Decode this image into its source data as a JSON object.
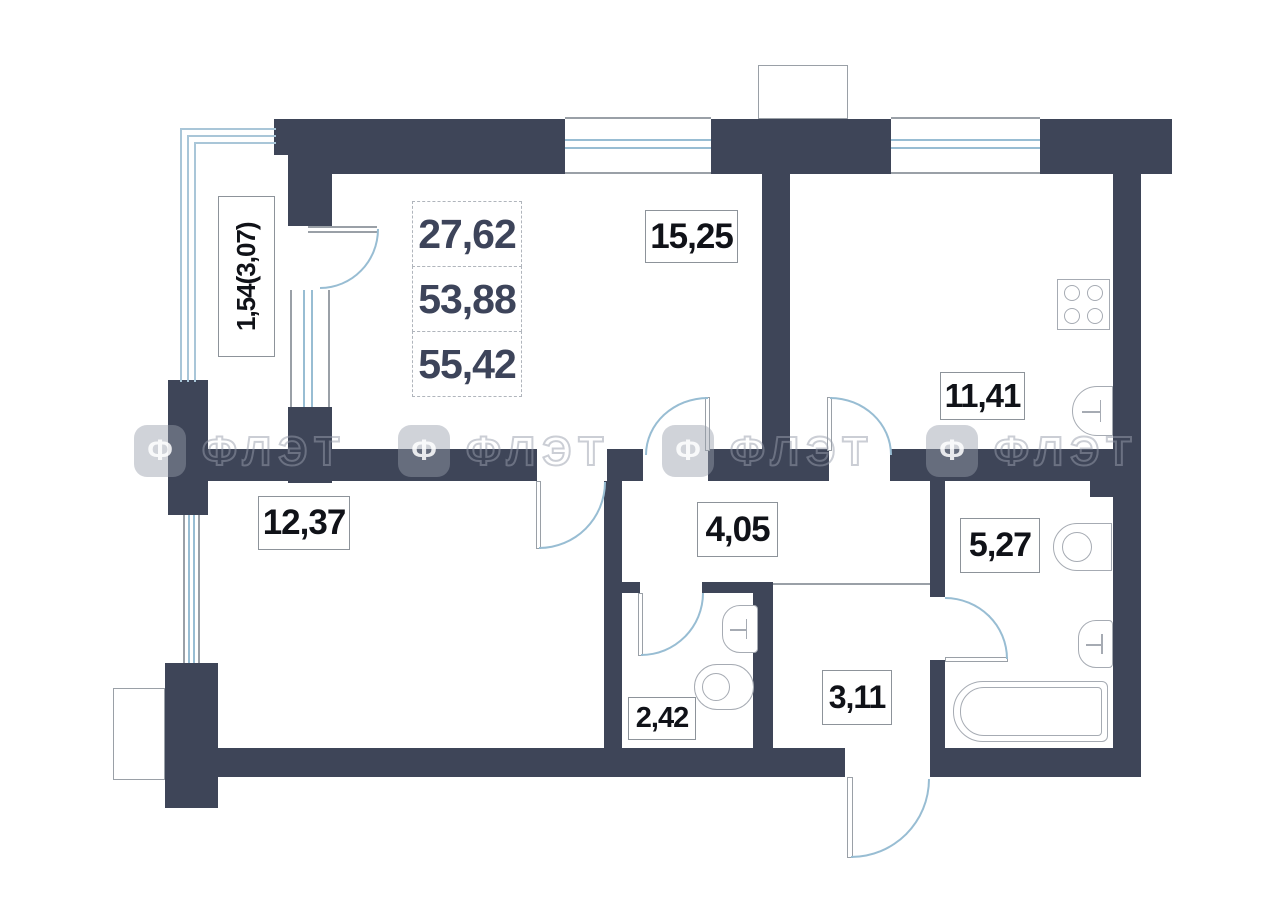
{
  "plan": {
    "title": "apartment-floor-plan",
    "area_summary": {
      "values": [
        "27,62",
        "53,88",
        "55,42"
      ]
    },
    "rooms": [
      {
        "id": "living",
        "label": "15,25"
      },
      {
        "id": "kitchen",
        "label": "11,41"
      },
      {
        "id": "bedroom",
        "label": "12,37"
      },
      {
        "id": "hall",
        "label": "4,05"
      },
      {
        "id": "bathroom",
        "label": "5,27"
      },
      {
        "id": "wc",
        "label": "2,42"
      },
      {
        "id": "hallway",
        "label": "3,11"
      },
      {
        "id": "balcony",
        "label": "1,54(3,07)"
      }
    ],
    "watermark": {
      "text": "ФЛЭТ",
      "logo_glyph": "Ф"
    },
    "colors": {
      "wall": "#3e4558",
      "window_line": "#98bdd3",
      "outline": "#9aa0a7",
      "label_text": "#101218",
      "area_text": "#3d445a"
    }
  }
}
